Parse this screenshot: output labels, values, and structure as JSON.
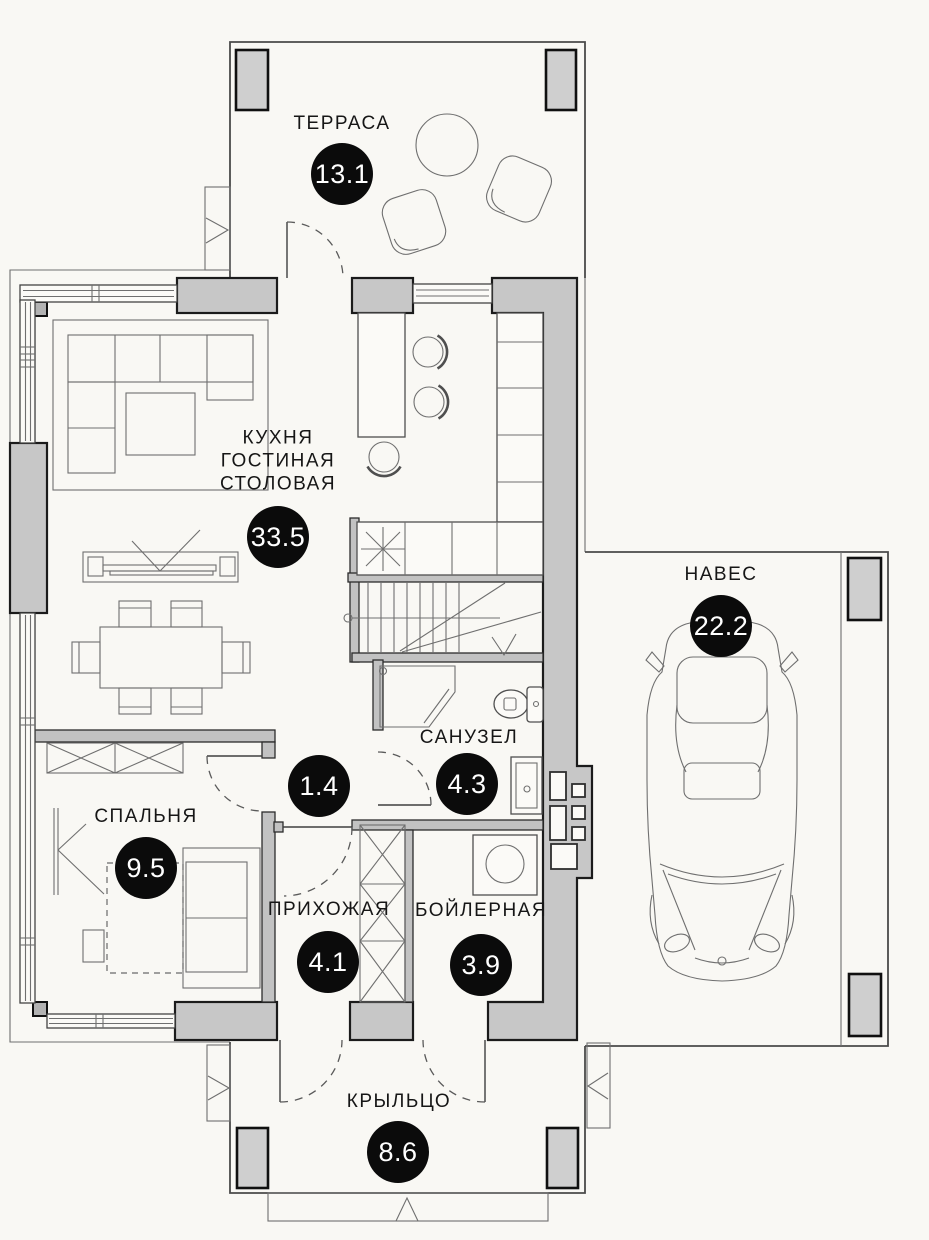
{
  "plan": {
    "title": "floor-plan",
    "colors": {
      "background": "#f9f8f4",
      "wall_fill": "#c7c7c7",
      "column_fill": "#cfcfcf",
      "line": "#3f3f3f",
      "badge": "#0b0b0b",
      "badge_text": "#ffffff"
    },
    "rooms": [
      {
        "id": "terrace",
        "name": "ТЕРРАСА",
        "area": "13.1"
      },
      {
        "id": "kitchen-living-dining",
        "lines": [
          "КУХНЯ",
          "ГОСТИНАЯ",
          "СТОЛОВАЯ"
        ],
        "area": "33.5"
      },
      {
        "id": "carport",
        "name": "НАВЕС",
        "area": "22.2"
      },
      {
        "id": "bathroom",
        "name": "САНУЗЕЛ",
        "area": "4.3"
      },
      {
        "id": "hall",
        "name": "",
        "area": "1.4"
      },
      {
        "id": "bedroom",
        "name": "СПАЛЬНЯ",
        "area": "9.5"
      },
      {
        "id": "entry",
        "name": "ПРИХОЖАЯ",
        "area": "4.1"
      },
      {
        "id": "boiler",
        "name": "БОЙЛЕРНАЯ",
        "area": "3.9"
      },
      {
        "id": "porch",
        "name": "КРЫЛЬЦО",
        "area": "8.6"
      }
    ]
  }
}
